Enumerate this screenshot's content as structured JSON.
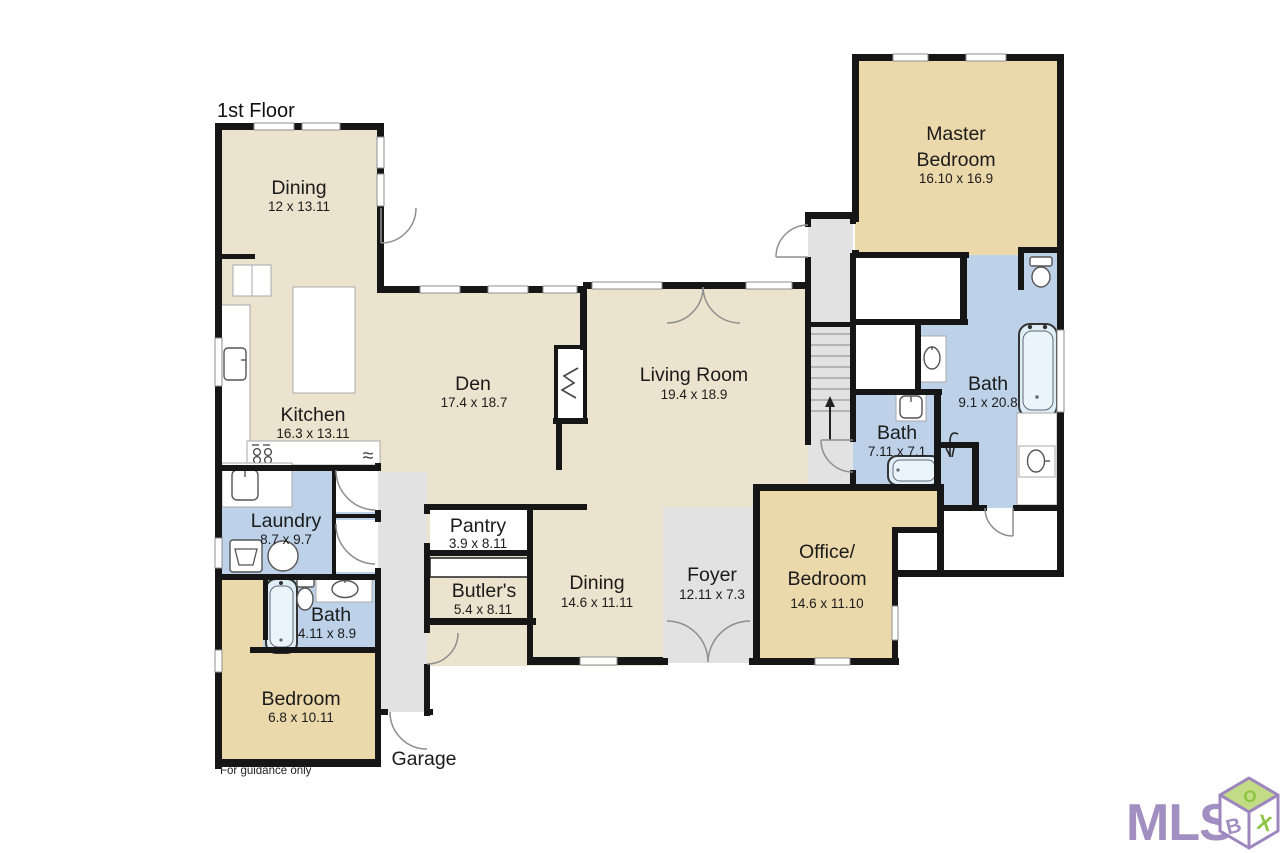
{
  "title": "1st Floor",
  "footnote": "For guidance only",
  "rooms": {
    "dining1": {
      "label": "Dining",
      "dims": "12 x 13.11"
    },
    "kitchen": {
      "label": "Kitchen",
      "dims": "16.3 x 13.11"
    },
    "den": {
      "label": "Den",
      "dims": "17.4 x 18.7"
    },
    "living": {
      "label": "Living Room",
      "dims": "19.4 x 18.9"
    },
    "master": {
      "line1": "Master",
      "line2": "Bedroom",
      "dims": "16.10 x 16.9"
    },
    "bath_master": {
      "label": "Bath",
      "dims": "9.1 x 20.8"
    },
    "bath_hall": {
      "label": "Bath",
      "dims": "7.11 x 7.1"
    },
    "office": {
      "line1": "Office/",
      "line2": "Bedroom",
      "dims": "14.6 x 11.10"
    },
    "foyer": {
      "label": "Foyer",
      "dims": "12.11 x 7.3"
    },
    "dining2": {
      "label": "Dining",
      "dims": "14.6 x 11.11"
    },
    "butlers": {
      "label": "Butler's",
      "dims": "5.4 x 8.11"
    },
    "pantry": {
      "label": "Pantry",
      "dims": "3.9 x 8.11"
    },
    "laundry": {
      "label": "Laundry",
      "dims": "8.7 x 9.7"
    },
    "bath_guest": {
      "label": "Bath",
      "dims": "4.11 x 8.9"
    },
    "bedroom": {
      "label": "Bedroom",
      "dims": "6.8 x 10.11"
    },
    "garage": {
      "label": "Garage"
    }
  },
  "icons": {
    "appliance_wave": "≈"
  },
  "watermark": {
    "text": "MLS",
    "cube_top": "O",
    "cube_left": "B",
    "cube_right": "X"
  },
  "colors": {
    "living_area": "#ece3ce",
    "bedroom_area": "#ebd8ab",
    "bath_area": "#bdd2e8",
    "hall_area": "#e2e2e2",
    "wall": "#161616",
    "logo_purple": "#a28fc2",
    "logo_green": "#8bc53f"
  }
}
